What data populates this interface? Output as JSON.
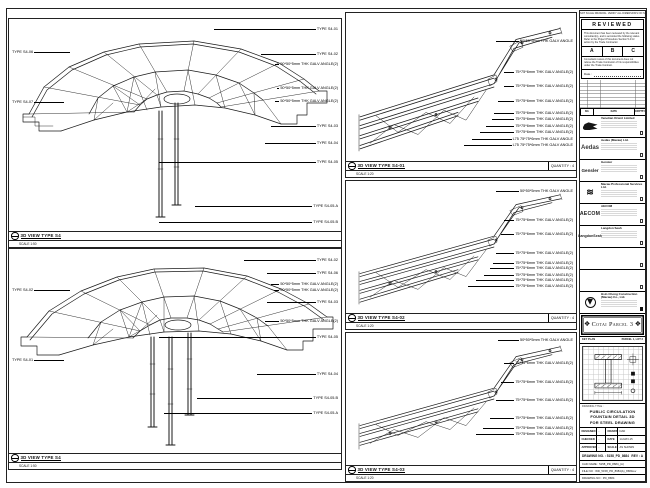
{
  "panels": {
    "p1": {
      "title": "3D VIEW TYPE S4",
      "scale": "SCALE 1:50",
      "labels_right": [
        {
          "t": "TYPE S4-01",
          "top": 9,
          "lx": 205
        },
        {
          "t": "TYPE S4-02",
          "top": 34,
          "lx": 252
        },
        {
          "t": "50*50*5mm THK GALV ANGLE(2)",
          "top": 44,
          "lx": 266
        },
        {
          "t": "50*50*5mm THK GALV ANGLE(2)",
          "top": 68,
          "lx": 268
        },
        {
          "t": "50*50*5mm THK GALV ANGLE(2)",
          "top": 81,
          "lx": 266
        },
        {
          "t": "TYPE S4-03",
          "top": 106,
          "lx": 262
        },
        {
          "t": "TYPE S4-04",
          "top": 123,
          "lx": 256
        },
        {
          "t": "TYPE S4-05",
          "top": 142,
          "lx": 150
        },
        {
          "t": "TYPE S4-05.A",
          "top": 186,
          "lx": 186
        },
        {
          "t": "TYPE S4-05.B",
          "top": 202,
          "lx": 150
        }
      ],
      "labels_left": [
        {
          "t": "TYPE S4-06",
          "top": 32,
          "w": 58
        },
        {
          "t": "TYPE S4-07",
          "top": 82,
          "w": 52
        }
      ]
    },
    "p2": {
      "title": "3D VIEW TYPE S4",
      "scale": "SCALE 1:50",
      "labels_right": [
        {
          "t": "TYPE S4-02",
          "top": 10,
          "lx": 235
        },
        {
          "t": "TYPE S4-06",
          "top": 23,
          "lx": 258
        },
        {
          "t": "50*50*5mm THK GALV ANGLE(2)",
          "top": 34,
          "lx": 262
        },
        {
          "t": "50*50*5mm THK GALV ANGLE(2)",
          "top": 40,
          "lx": 265
        },
        {
          "t": "TYPE S4-03",
          "top": 52,
          "lx": 258
        },
        {
          "t": "50*50*5mm THK GALV ANGLE(2)",
          "top": 71,
          "lx": 256
        },
        {
          "t": "TYPE S4-05",
          "top": 87,
          "lx": 150
        },
        {
          "t": "TYPE S4-04",
          "top": 124,
          "lx": 248
        },
        {
          "t": "TYPE S4-05.B",
          "top": 148,
          "lx": 188
        },
        {
          "t": "TYPE S4-05.A",
          "top": 163,
          "lx": 155
        }
      ],
      "labels_left": [
        {
          "t": "TYPE S4-02",
          "top": 40,
          "w": 58
        },
        {
          "t": "TYPE S4-01",
          "top": 110,
          "w": 52
        }
      ]
    },
    "pa": {
      "title": "3D VIEW TYPE S4-01",
      "scale": "SCALE 1:20",
      "qty": "QUANTITY : 4",
      "labels_right": [
        {
          "t": "50*50*5mm THK GALV ANGLE",
          "top": 27,
          "lx": 150
        },
        {
          "t": "75*75*6mm THK GALV ANGLE(2)",
          "top": 58,
          "lx": 158
        },
        {
          "t": "75*75*6mm THK GALV ANGLE(2)",
          "top": 72,
          "lx": 158
        },
        {
          "t": "75*75*6mm THK GALV ANGLE(2)",
          "top": 87,
          "lx": 152
        },
        {
          "t": "75*75*6mm THK GALV ANGLE(2)",
          "top": 99,
          "lx": 148
        },
        {
          "t": "75*75*6mm THK GALV ANGLE(2)",
          "top": 105,
          "lx": 146
        },
        {
          "t": "75*75*6mm THK GALV ANGLE(2)",
          "top": 112,
          "lx": 140
        },
        {
          "t": "75*75*6mm THK GALV ANGLE(2)",
          "top": 118,
          "lx": 134
        },
        {
          "t": "L75 75*75*6mm THK GALV ANGLE",
          "top": 125,
          "lx": 126
        },
        {
          "t": "L75 75*75*6mm THK GALV ANGLE",
          "top": 131,
          "lx": 118
        }
      ]
    },
    "pb": {
      "title": "3D VIEW TYPE S4-02",
      "scale": "SCALE 1:20",
      "qty": "QUANTITY : 4",
      "labels_right": [
        {
          "t": "50*50*5mm THK GALV ANGLE",
          "top": 9,
          "lx": 150
        },
        {
          "t": "75*75*6mm THK GALV ANGLE(2)",
          "top": 38,
          "lx": 158
        },
        {
          "t": "75*75*6mm THK GALV ANGLE(2)",
          "top": 52,
          "lx": 155
        },
        {
          "t": "75*75*6mm THK GALV ANGLE(2)",
          "top": 71,
          "lx": 150
        },
        {
          "t": "75*75*6mm THK GALV ANGLE(2)",
          "top": 81,
          "lx": 147
        },
        {
          "t": "75*75*6mm THK GALV ANGLE(2)",
          "top": 86,
          "lx": 144
        },
        {
          "t": "75*75*6mm THK GALV ANGLE(2)",
          "top": 93,
          "lx": 138
        },
        {
          "t": "75*75*6mm THK GALV ANGLE(2)",
          "top": 98,
          "lx": 130
        },
        {
          "t": "75*75*6mm THK GALV ANGLE(2)",
          "top": 104,
          "lx": 122
        }
      ]
    },
    "pc": {
      "title": "3D VIEW TYPE S4-03",
      "scale": "SCALE 1:20",
      "qty": "QUANTITY : 4",
      "labels_right": [
        {
          "t": "50*50*5mm THK GALV ANGLE",
          "top": 6,
          "lx": 152
        },
        {
          "t": "75*75*6mm THK GALV ANGLE(2)",
          "top": 29,
          "lx": 158
        },
        {
          "t": "75*75*6mm THK GALV ANGLE(2)",
          "top": 48,
          "lx": 155
        },
        {
          "t": "75*75*6mm THK GALV ANGLE(2)",
          "top": 66,
          "lx": 150
        },
        {
          "t": "75*75*6mm THK GALV ANGLE(2)",
          "top": 84,
          "lx": 144
        },
        {
          "t": "75*75*6mm THK GALV ANGLE(2)",
          "top": 94,
          "lx": 137
        },
        {
          "t": "75*75*6mm THK GALV ANGLE(2)",
          "top": 100,
          "lx": 130
        }
      ]
    }
  },
  "titleblock": {
    "header_note": "DO NOT SCALE DRAWING. VERIFY ALL DIMENSIONS ON SITE.",
    "stamp": {
      "title": "REVIEWED",
      "body": "This document has been reviewed by the relevant consultant(s), and is accorded the following status. Refer to the Project Procedure Section 5.4 for action by the Trade Contractor.",
      "options": [
        "A",
        "B",
        "C"
      ],
      "note": "Consultant review of this document does not relieve the Trade Contractor of his responsibilities under the Trade Contract.",
      "date_label": "Date :"
    },
    "rev_header": [
      "NO.",
      "DATE",
      "DESCRIPTION",
      "BY"
    ],
    "companies": [
      {
        "logo": "logo-venetian",
        "mark": "",
        "name": "Venetian Orient Limited",
        "chk": "box",
        "rowcls": ""
      },
      {
        "logo": "logo-aedas",
        "mark": "Aedas",
        "name": "Aedas (Macau) Ltd.",
        "chk": "box",
        "rowcls": ""
      },
      {
        "logo": "logo-gensler",
        "mark": "Gensler",
        "name": "Gensler",
        "chk": "box",
        "rowcls": ""
      },
      {
        "logo": "logo-wave",
        "mark": "",
        "name": "Macau Professional Services Ltd.",
        "chk": "box",
        "rowcls": ""
      },
      {
        "logo": "logo-aecom",
        "mark": "AECOM",
        "name": "AECOM",
        "chk": "box",
        "rowcls": ""
      },
      {
        "logo": "logo-ls",
        "mark": "LangdonSeah",
        "name": "Langdon Seah",
        "chk": "box",
        "rowcls": ""
      },
      {
        "logo": "",
        "mark": "",
        "name": "",
        "chk": "box",
        "rowcls": "empty"
      },
      {
        "logo": "",
        "mark": "",
        "name": "",
        "chk": "box",
        "rowcls": "empty"
      },
      {
        "logo": "logo-hc",
        "mark": "",
        "name": "Hsin Chong Construction (Macau) Co., Ltd.",
        "chk": "filled",
        "rowcls": ""
      }
    ],
    "project": "Cotai Parcel 3",
    "keyplan_label": "KEY PLAN",
    "keyplan_ref": "PARCEL 1, LOT 2",
    "title_label": "DRAWING TITLE :",
    "title_lines": [
      "PUBLIC CIRCULATION",
      "FOUNTAIN DETAIL 3D",
      "FOR STEEL DRAWING"
    ],
    "fields": [
      {
        "l": "DESIGNED",
        "lv": "-",
        "r": "DRAWN",
        "rv": "DAD"
      },
      {
        "l": "CHECKED",
        "lv": "-",
        "r": "DATE",
        "rv": "14-MAY-15"
      },
      {
        "l": "APPROVED",
        "lv": "-",
        "r": "SCALE",
        "rv": "AS SHOWN"
      }
    ],
    "drawing_no": "DRAWING NO. : 5158_PD_8684",
    "rev": "REV : A",
    "cad_row": "CAD NAME : 5158_PD_8684_(A)",
    "file_row": "FILE NO : WD_5158_PD_8684(A)_8684rev",
    "last_row": "DRAWING NO : PD_8684"
  }
}
